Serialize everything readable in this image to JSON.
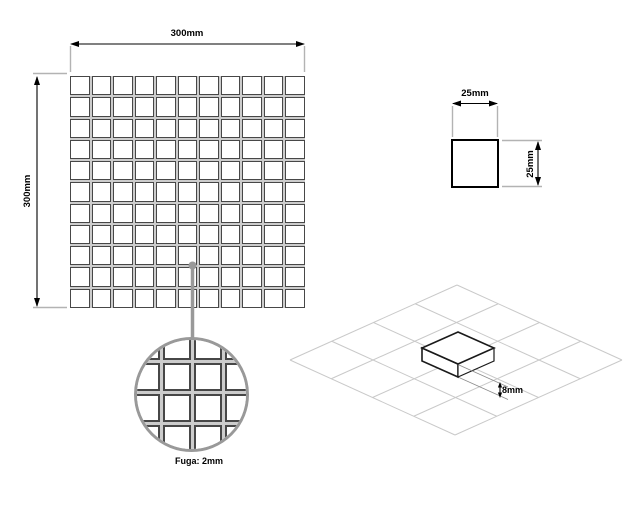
{
  "diagram": {
    "sheet": {
      "width_label": "300mm",
      "height_label": "300mm",
      "rows": 11,
      "cols": 11
    },
    "tile": {
      "width_label": "25mm",
      "height_label": "25mm"
    },
    "grout": {
      "label": "Fuga: 2mm"
    },
    "thickness": {
      "label": "8mm"
    },
    "detail_grid": {
      "rows": 5,
      "cols": 5
    }
  },
  "colors": {
    "line": "#000000",
    "extension": "#b3b3b3",
    "leader": "#999999",
    "grout-dark": "#474747",
    "grout-light": "#cccccc",
    "iso-grid": "#c9c9c9"
  }
}
